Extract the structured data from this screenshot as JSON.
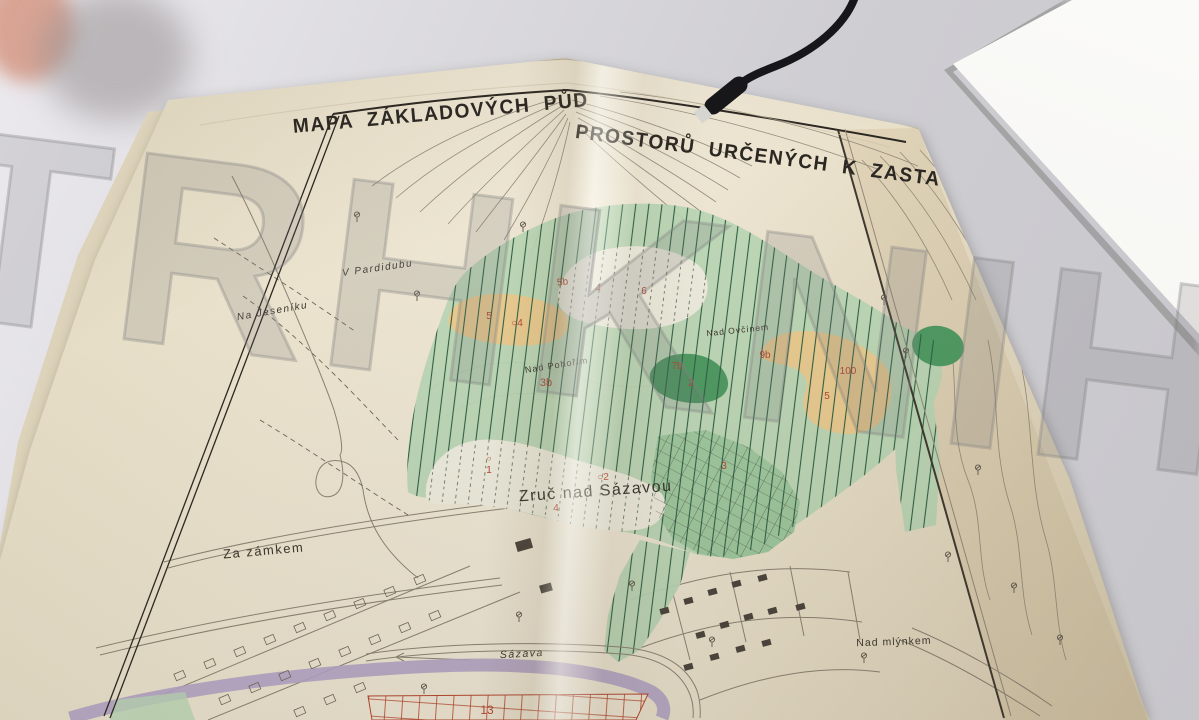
{
  "scene": {
    "watermark": {
      "text": "TRHKNIH"
    },
    "title": {
      "left": "MAPA ZÁKLADOVÝCH PŮD",
      "right": "PROSTORŮ URČENÝCH K ZASTAVĚNÍ"
    },
    "labels": [
      {
        "text": "V Pardidubu"
      },
      {
        "text": "Na Jeseníku"
      },
      {
        "text": "Nad Ovčínem"
      },
      {
        "text": "Nad Pohořím"
      },
      {
        "text": "Zruč nad Sázavou"
      },
      {
        "text": "Za zámkem"
      },
      {
        "text": "Sázava"
      },
      {
        "text": "Nad mlýnkem"
      }
    ],
    "markers": [
      {
        "text": "5b"
      },
      {
        "text": "4"
      },
      {
        "text": "6"
      },
      {
        "text": "5"
      },
      {
        "text": "○4"
      },
      {
        "text": "3b"
      },
      {
        "text": "7b"
      },
      {
        "text": "2"
      },
      {
        "text": "9b"
      },
      {
        "text": "100"
      },
      {
        "text": "5"
      },
      {
        "text": "○"
      },
      {
        "text": "1"
      },
      {
        "text": "○2"
      },
      {
        "text": "3"
      },
      {
        "text": "4"
      },
      {
        "text": "13"
      }
    ],
    "colors": {
      "ink": "#2b2722",
      "linework": "#8c8273",
      "green_light": "#b9d6b4",
      "green_medium": "#9fc89e",
      "green_dark": "#4f9a63",
      "hatch_green": "#2f5f45",
      "tan": "#e9cb90",
      "pale": "#edebdd",
      "purple": "#b2a3c5",
      "red": "#b5462e",
      "paper": "#ebe3ce",
      "table": "#cfced3",
      "white_sheet": "#f7f6f2",
      "cable": "#17171a",
      "watermark_gray": "#808082"
    }
  }
}
